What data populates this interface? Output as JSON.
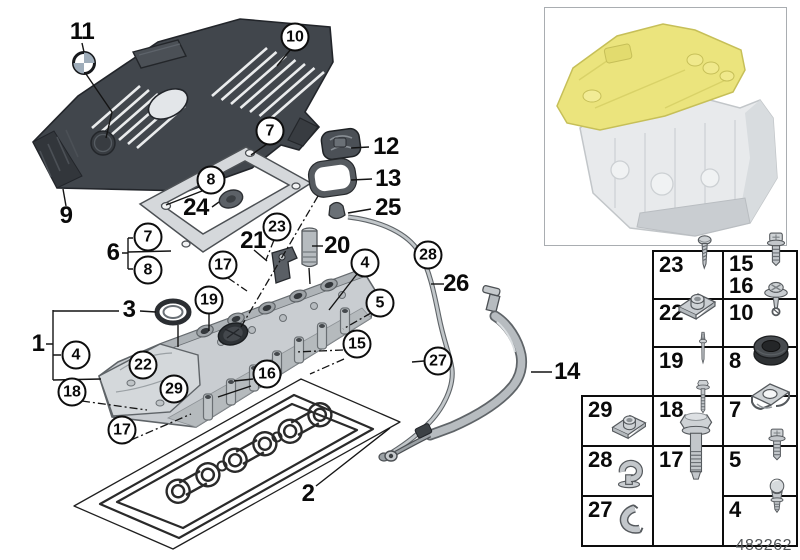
{
  "colors": {
    "highlight_yellow": "#ebe47d",
    "engine_cover_dark": "#3f444a",
    "metal_light": "#c9cdd1",
    "line": "#1a1a1a"
  },
  "diagram": {
    "doc_number": "483262",
    "callouts": [
      {
        "label": "11",
        "shape": "plain"
      },
      {
        "label": "10",
        "shape": "circle"
      },
      {
        "label": "9",
        "shape": "plain"
      },
      {
        "label": "12",
        "shape": "plain"
      },
      {
        "label": "13",
        "shape": "plain"
      },
      {
        "label": "25",
        "shape": "plain"
      },
      {
        "label": "24",
        "shape": "plain"
      },
      {
        "label": "7",
        "shape": "circle"
      },
      {
        "label": "8",
        "shape": "circle"
      },
      {
        "label": "6",
        "shape": "plain"
      },
      {
        "label": "7",
        "shape": "circle"
      },
      {
        "label": "8",
        "shape": "circle"
      },
      {
        "label": "21",
        "shape": "plain"
      },
      {
        "label": "23",
        "shape": "circle"
      },
      {
        "label": "20",
        "shape": "plain"
      },
      {
        "label": "17",
        "shape": "circle"
      },
      {
        "label": "4",
        "shape": "circle"
      },
      {
        "label": "28",
        "shape": "circle"
      },
      {
        "label": "26",
        "shape": "plain"
      },
      {
        "label": "19",
        "shape": "circle"
      },
      {
        "label": "5",
        "shape": "circle"
      },
      {
        "label": "3",
        "shape": "plain"
      },
      {
        "label": "1",
        "shape": "plain"
      },
      {
        "label": "4",
        "shape": "circle"
      },
      {
        "label": "22",
        "shape": "circle"
      },
      {
        "label": "15",
        "shape": "circle"
      },
      {
        "label": "16",
        "shape": "circle"
      },
      {
        "label": "29",
        "shape": "circle"
      },
      {
        "label": "18",
        "shape": "circle"
      },
      {
        "label": "27",
        "shape": "circle"
      },
      {
        "label": "17",
        "shape": "circle"
      },
      {
        "label": "2",
        "shape": "plain"
      },
      {
        "label": "14",
        "shape": "plain"
      }
    ]
  },
  "thumbnail": {
    "highlight_part": "cylinder-head-cover",
    "highlight_color": "#ebe47d"
  },
  "table": {
    "cells": [
      {
        "labels": [
          "23"
        ],
        "icon": "tapping-screw"
      },
      {
        "labels": [
          "15",
          "16"
        ],
        "icon": "torx-bolt"
      },
      {
        "labels": [
          "22"
        ],
        "icon": "cage-nut"
      },
      {
        "labels": [
          "10"
        ],
        "icon": "washer-screw"
      },
      {
        "labels": [
          "19"
        ],
        "icon": "stud-bolt"
      },
      {
        "labels": [
          "8"
        ],
        "icon": "rubber-grommet"
      },
      {
        "labels": [
          "29"
        ],
        "icon": "cage-nut"
      },
      {
        "labels": [
          "18"
        ],
        "icon": "flange-bolt"
      },
      {
        "labels": [
          "7"
        ],
        "icon": "spring-nut"
      },
      {
        "labels": [
          "28"
        ],
        "icon": "cable-clip"
      },
      {
        "labels": [
          "17"
        ],
        "icon": "hex-bolt"
      },
      {
        "labels": [
          "5"
        ],
        "icon": "torx-bolt"
      },
      {
        "labels": [
          "27"
        ],
        "icon": "hose-clip"
      },
      {
        "labels": [
          "4"
        ],
        "icon": "ball-stud"
      }
    ]
  }
}
